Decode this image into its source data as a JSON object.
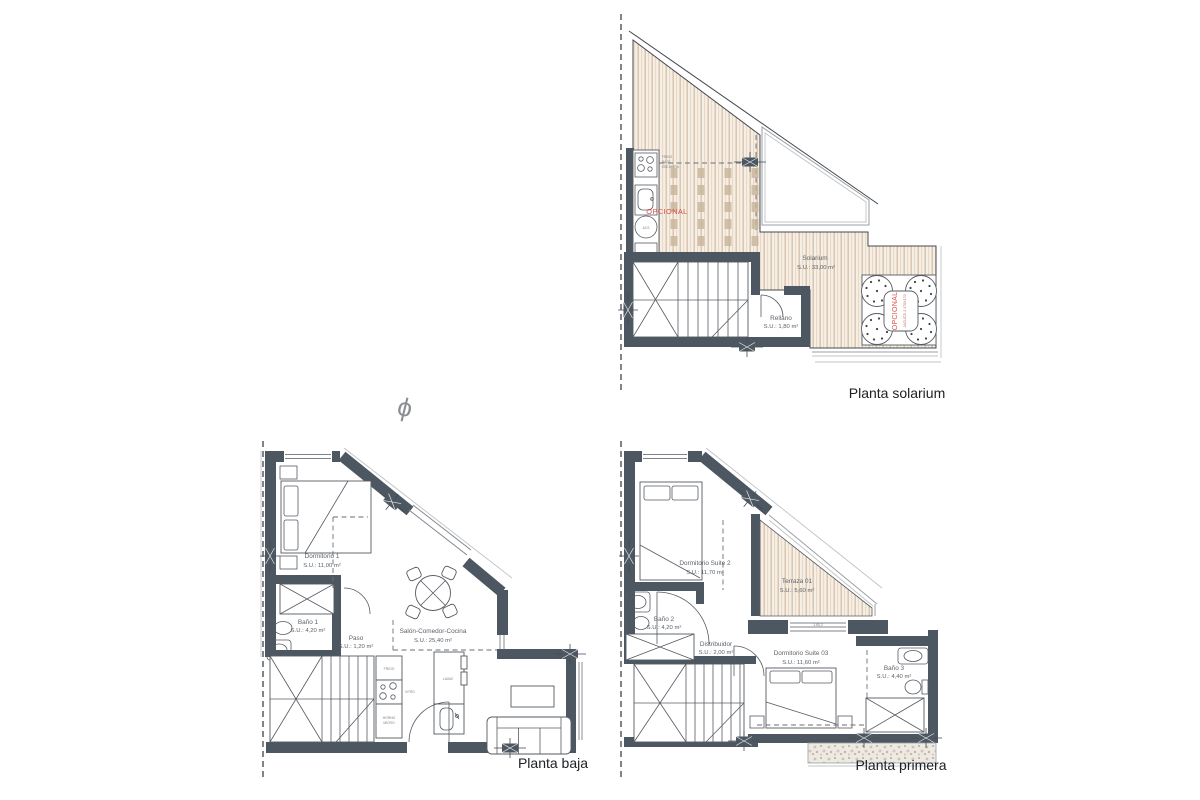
{
  "plan_solarium": {
    "title": "Planta solarium",
    "solarium_name": "Solarium",
    "solarium_area": "S.U.: 33,00 m²",
    "rellano_name": "Rellano",
    "rellano_area": "S.U.: 1,80 m²",
    "opcional_kitchen": "OPCIONAL",
    "jacuzzi_opcional": "OPCIONAL",
    "jacuzzi_spec": "JACUZZI 2 170X170",
    "frigo_l1": "FRIGO",
    "frigo_l2": "BAJO",
    "frigo_l3": "ENCIMERA",
    "acs": "ACS"
  },
  "plan_baja": {
    "title": "Planta baja",
    "dormitorio1_name": "Dormitorio 1",
    "dormitorio1_area": "S.U.: 11,00 m²",
    "bano1_name": "Baño 1",
    "bano1_area": "S.U.: 4,20 m²",
    "paso_name": "Paso",
    "paso_area": "S.U.: 1,20 m²",
    "salon_name": "Salón-Comedor-Cocina",
    "salon_area": "S.U.: 25,40 m²",
    "frigo": "FRIGO",
    "vitro": "VITRO",
    "horno_l1": "HORNO",
    "horno_l2": "MICRO",
    "lavav": "LAVAV"
  },
  "plan_primera": {
    "title": "Planta primera",
    "suite2_name": "Dormitorio Suite 2",
    "suite2_area": "S.U.: 11,70 m²",
    "bano2_name": "Baño 2",
    "bano2_area": "S.U.: 4,20 m²",
    "distribuidor_name": "Distribuidor",
    "distribuidor_area": "S.U.: 2,00 m²",
    "terraza_name": "Terraza 01",
    "terraza_area": "S.U.: 5,60 m²",
    "suite03_name": "Dormitorio Suite 03",
    "suite03_area": "S.U.: 11,60 m²",
    "bano3_name": "Baño 3",
    "bano3_area": "S.U.: 4,40 m²",
    "dim_label": "1.60,2"
  },
  "symbols": {
    "phi": "ϕ"
  },
  "colors": {
    "wall": "#4d5761",
    "wood_line": "#d9c2a9",
    "accent_red": "#d84f44"
  }
}
